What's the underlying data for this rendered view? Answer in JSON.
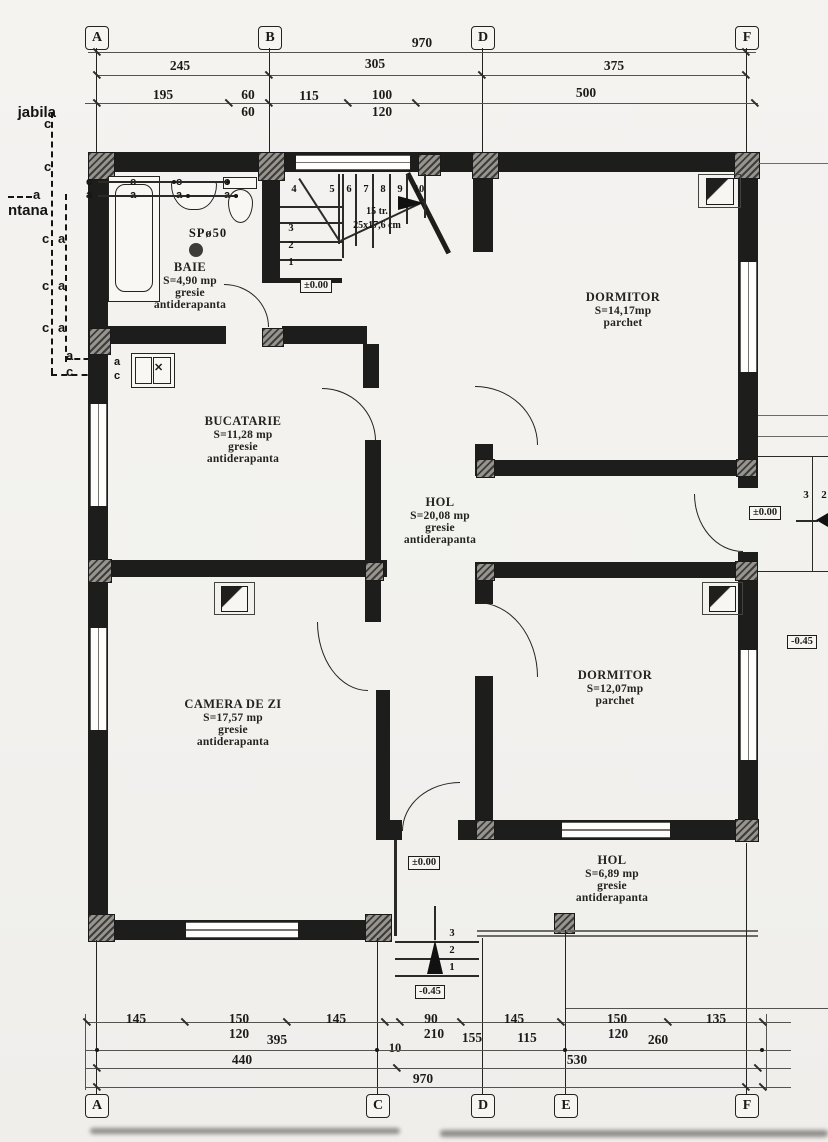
{
  "grid": {
    "top": [
      "A",
      "B",
      "D",
      "F"
    ],
    "bottom": [
      "A",
      "C",
      "D",
      "E",
      "F"
    ]
  },
  "dims": {
    "t1": [
      "970"
    ],
    "t2": [
      "245",
      "305",
      "375"
    ],
    "t3": [
      "195",
      "60",
      "115",
      "100",
      "500"
    ],
    "t3b": [
      "60",
      "120"
    ],
    "b1": [
      "145",
      "150",
      "145",
      "90",
      "145",
      "150",
      "135"
    ],
    "b1b": [
      "120",
      "395",
      "210",
      "155",
      "115",
      "120",
      "260",
      "10"
    ],
    "b2": [
      "440",
      "530"
    ],
    "b3": [
      "970"
    ]
  },
  "rooms": [
    {
      "name": "BAIE",
      "area": "S=4,90 mp",
      "f1": "gresie",
      "f2": "antiderapanta"
    },
    {
      "name": "BUCATARIE",
      "area": "S=11,28 mp",
      "f1": "gresie",
      "f2": "antiderapanta"
    },
    {
      "name": "DORMITOR",
      "area": "S=14,17mp",
      "f1": "parchet",
      "f2": ""
    },
    {
      "name": "HOL",
      "area": "S=20,08 mp",
      "f1": "gresie",
      "f2": "antiderapanta"
    },
    {
      "name": "CAMERA DE ZI",
      "area": "S=17,57 mp",
      "f1": "gresie",
      "f2": "antiderapanta"
    },
    {
      "name": "DORMITOR",
      "area": "S=12,07mp",
      "f1": "parchet",
      "f2": ""
    },
    {
      "name": "HOL",
      "area": "S=6,89 mp",
      "f1": "gresie",
      "f2": "antiderapanta"
    }
  ],
  "stairs": {
    "n1": "1",
    "n2": "2",
    "n3": "3",
    "n4": "4",
    "n5": "5",
    "n6": "6",
    "n7": "7",
    "n8": "8",
    "n9": "9",
    "n10": "10",
    "tr": "15 tr.",
    "size": "25x17,6 cm"
  },
  "levels": {
    "zero": "±0.00",
    "minus": "-0.45"
  },
  "drain": "SPø50",
  "pipes": {
    "c": "c",
    "a": "a",
    "cut_top": "jabila",
    "cut_mid": "ntana"
  },
  "exterior_steps": {
    "south": [
      "3",
      "2",
      "1"
    ],
    "east": [
      "3",
      "2"
    ]
  }
}
